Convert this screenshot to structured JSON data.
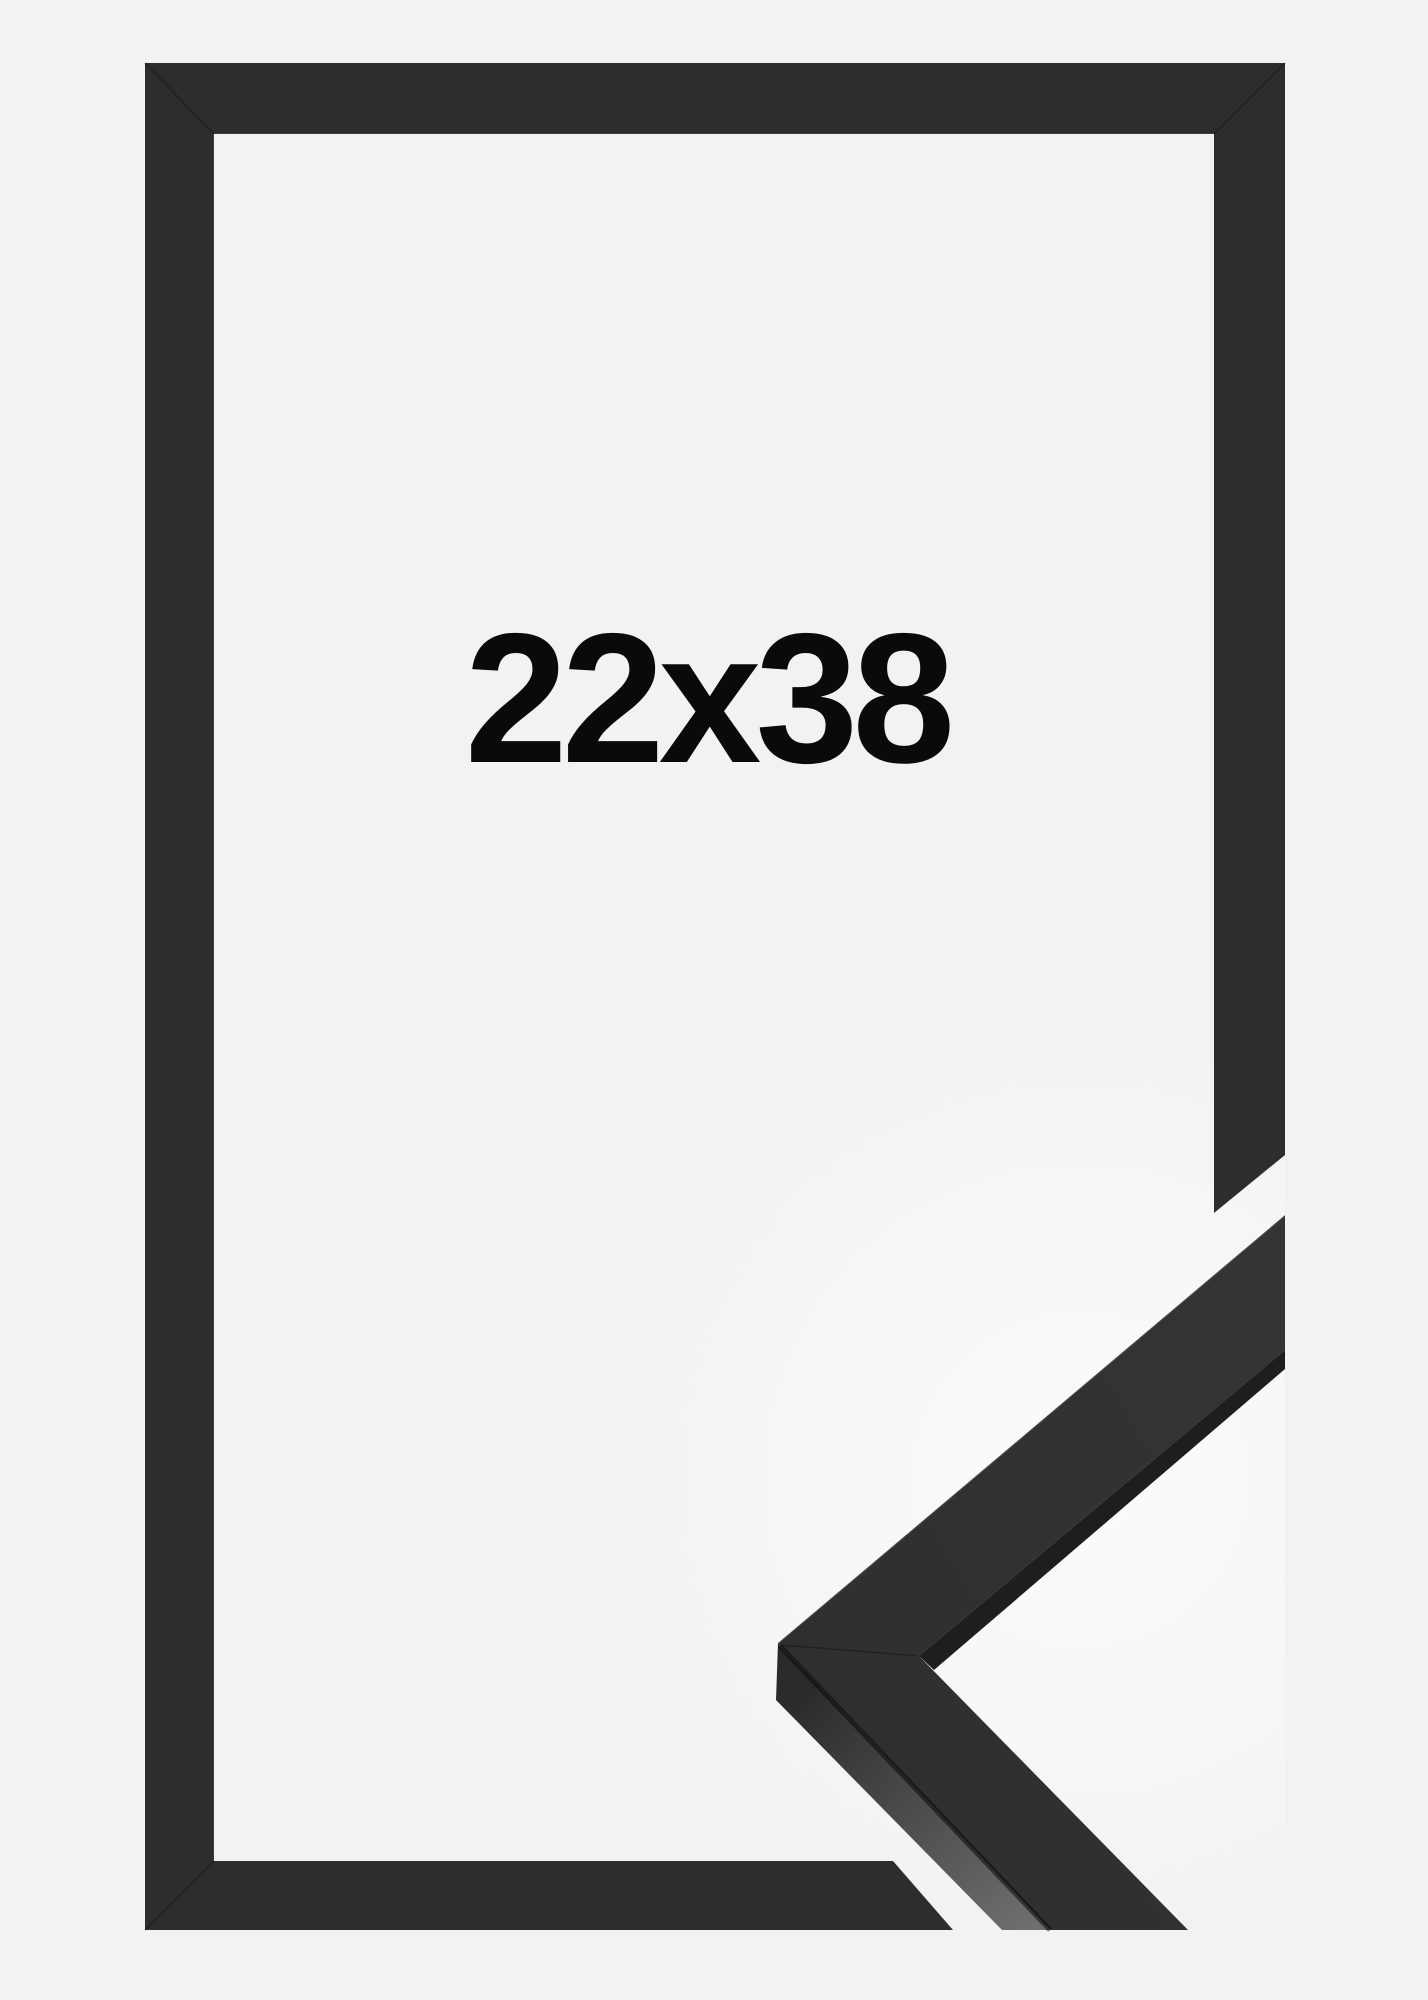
{
  "page": {
    "background_color": "#f1f2f2"
  },
  "product_photo": {
    "description": "black picture frame with cut-away corner profile sample",
    "size_label": "22x38",
    "label_color": "#0a0a0b",
    "frame": {
      "face_color": "#2c2d2f"
    },
    "corner_sample": {
      "face_color": "#323436",
      "inner_edge_color": "#1d1e1f",
      "side_color_dark": "#2a2a2b",
      "side_color_bright": "#6e6f70"
    }
  }
}
